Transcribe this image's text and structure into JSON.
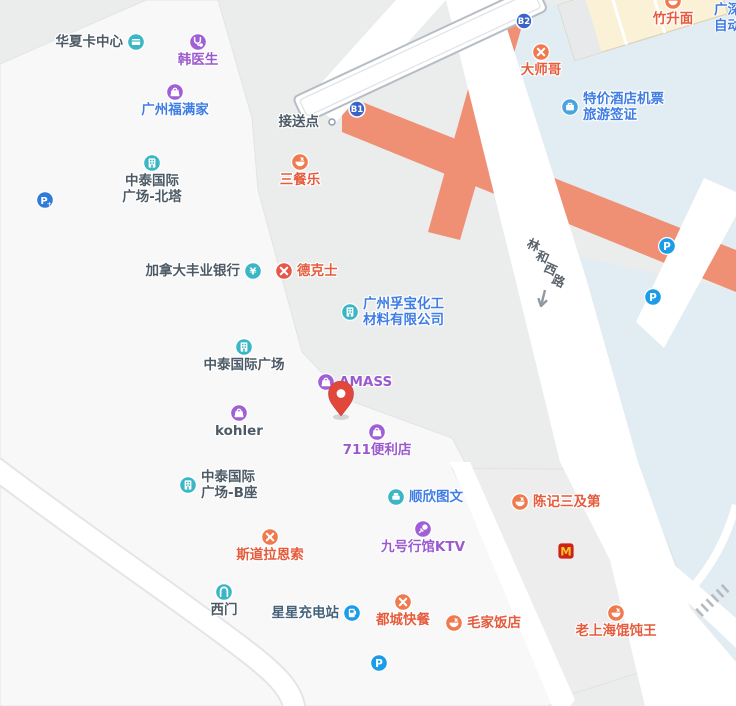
{
  "map_type": "street-map",
  "colors": {
    "base": "#ebecec",
    "block_light": "#f8f8f9",
    "block_gray": "#ededee",
    "area_blue": "#e2ecf3",
    "building_cream": "#fbf1d6",
    "walkway_salmon": "#ef8f74",
    "road_white": "#ffffff",
    "bridge_casing": "#b6bdc5",
    "cat_teal": "#3bb6c4",
    "cat_purple": "#a05fd6",
    "cat_orange": "#ef7a4e",
    "cat_red": "#e8584a",
    "cat_blue": "#4aa4e0",
    "cat_parking": "#1b9ce8",
    "cat_parking_plus": "#2e7bd8",
    "badge_blue": "#3a63c8",
    "mcd_bg": "#cf2318",
    "mcd_m": "#f7c325",
    "pin_red": "#e2473c"
  },
  "text_colors": {
    "dark": "#4d5a66",
    "blue": "#3f7de4",
    "purple": "#9b59d0",
    "orange": "#e55b3c",
    "steel": "#47637a"
  },
  "road": {
    "name": "林和西路",
    "chars": [
      "林",
      "和",
      "西",
      "路"
    ],
    "char_positions": [
      [
        534,
        244
      ],
      [
        543,
        256
      ],
      [
        551,
        268
      ],
      [
        559,
        280
      ]
    ]
  },
  "corner_text": {
    "line1": "广深",
    "line2": "自动"
  },
  "badges": [
    {
      "id": "metro-exit-b1",
      "label": "B1",
      "x": 357,
      "y": 109
    },
    {
      "id": "metro-exit-b2",
      "label": "B2",
      "x": 524,
      "y": 21
    }
  ],
  "pin": {
    "x": 341,
    "y": 419
  },
  "pois": [
    {
      "id": "huaxia-card-center",
      "label": "华夏卡中心",
      "icon": "card",
      "cat": "teal",
      "text": "dark",
      "x": 136,
      "y": 42,
      "pos": "left"
    },
    {
      "id": "han-doctor",
      "label": "韩医生",
      "icon": "medical",
      "cat": "purple",
      "text": "purple",
      "x": 198,
      "y": 42,
      "pos": "below"
    },
    {
      "id": "guangzhou-fumanjia",
      "label": "广州福满家",
      "icon": "bag",
      "cat": "purple",
      "text": "blue",
      "x": 175,
      "y": 92,
      "pos": "below"
    },
    {
      "id": "zhongtai-north-tower",
      "lines": [
        "中泰国际",
        "广场-北塔"
      ],
      "icon": "building",
      "cat": "teal",
      "text": "dark",
      "x": 152,
      "y": 163,
      "pos": "below"
    },
    {
      "id": "parking-plus-west",
      "icon": "parking-plus",
      "cat": "parking_plus",
      "x": 45,
      "y": 200,
      "pos": "none"
    },
    {
      "id": "pickup-point",
      "label": "接送点",
      "icon": "dot",
      "text": "dark",
      "x": 332,
      "y": 122,
      "pos": "left"
    },
    {
      "id": "sancanle",
      "label": "三餐乐",
      "icon": "bowl",
      "cat": "orange",
      "text": "orange",
      "x": 300,
      "y": 162,
      "pos": "below"
    },
    {
      "id": "dashige",
      "label": "大师哥",
      "icon": "utensils",
      "cat": "orange",
      "text": "orange",
      "x": 541,
      "y": 52,
      "pos": "below"
    },
    {
      "id": "zhushengmian",
      "label": "竹升面",
      "icon": "bowl",
      "cat": "orange",
      "text": "orange",
      "x": 673,
      "y": 1,
      "pos": "below"
    },
    {
      "id": "hotel-flight-deals",
      "lines": [
        "特价酒店机票",
        "旅游签证"
      ],
      "icon": "travel",
      "cat": "blue",
      "text": "blue",
      "x": 570,
      "y": 107,
      "pos": "right"
    },
    {
      "id": "scotiabank-canada",
      "label": "加拿大丰业银行",
      "icon": "yen",
      "cat": "teal",
      "text": "dark",
      "x": 253,
      "y": 271,
      "pos": "left"
    },
    {
      "id": "dicos",
      "label": "德克士",
      "icon": "utensils",
      "cat": "red",
      "text": "orange",
      "x": 284,
      "y": 271,
      "pos": "right"
    },
    {
      "id": "fubao-chemical",
      "lines": [
        "广州孚宝化工",
        "材料有限公司"
      ],
      "icon": "building",
      "cat": "teal",
      "text": "blue",
      "x": 350,
      "y": 312,
      "pos": "right"
    },
    {
      "id": "zhongtai-plaza",
      "label": "中泰国际广场",
      "icon": "building",
      "cat": "teal",
      "text": "dark",
      "x": 244,
      "y": 347,
      "pos": "below"
    },
    {
      "id": "amass",
      "label": "AMASS",
      "icon": "bag",
      "cat": "purple",
      "text": "purple",
      "x": 326,
      "y": 382,
      "pos": "right"
    },
    {
      "id": "kohler",
      "label": "kohler",
      "icon": "bag",
      "cat": "purple",
      "text": "dark",
      "x": 239,
      "y": 413,
      "pos": "below"
    },
    {
      "id": "store-711",
      "label": "711便利店",
      "icon": "bag",
      "cat": "purple",
      "text": "purple",
      "x": 377,
      "y": 432,
      "pos": "below"
    },
    {
      "id": "zhongtai-tower-b",
      "lines": [
        "中泰国际",
        "广场-B座"
      ],
      "icon": "building",
      "cat": "teal",
      "text": "dark",
      "x": 188,
      "y": 485,
      "pos": "right"
    },
    {
      "id": "shunxin-print",
      "label": "顺欣图文",
      "icon": "printer",
      "cat": "teal",
      "text": "blue",
      "x": 396,
      "y": 497,
      "pos": "right"
    },
    {
      "id": "chenji-sanjidi",
      "label": "陈记三及第",
      "icon": "bowl",
      "cat": "orange",
      "text": "orange",
      "x": 520,
      "y": 502,
      "pos": "right"
    },
    {
      "id": "stora-enso",
      "label": "斯道拉恩索",
      "icon": "utensils",
      "cat": "orange",
      "text": "orange",
      "x": 270,
      "y": 537,
      "pos": "below"
    },
    {
      "id": "ktv-no9",
      "label": "九号行馆KTV",
      "icon": "mic",
      "cat": "purple",
      "text": "purple",
      "x": 423,
      "y": 529,
      "pos": "below"
    },
    {
      "id": "mcdonalds",
      "icon": "mcd",
      "x": 566,
      "y": 551,
      "pos": "none"
    },
    {
      "id": "west-gate",
      "label": "西门",
      "icon": "gate",
      "cat": "teal",
      "text": "dark",
      "x": 224,
      "y": 592,
      "pos": "below"
    },
    {
      "id": "star-charging",
      "label": "星星充电站",
      "icon": "charger",
      "cat": "parking",
      "text": "steel",
      "x": 352,
      "y": 613,
      "pos": "left"
    },
    {
      "id": "ducheng-fastfood",
      "label": "都城快餐",
      "icon": "utensils",
      "cat": "orange",
      "text": "orange",
      "x": 403,
      "y": 602,
      "pos": "below"
    },
    {
      "id": "maojia-restaurant",
      "label": "毛家饭店",
      "icon": "bowl",
      "cat": "orange",
      "text": "orange",
      "x": 454,
      "y": 623,
      "pos": "right"
    },
    {
      "id": "old-shanghai-wonton",
      "label": "老上海馄饨王",
      "icon": "bowl",
      "cat": "orange",
      "text": "orange",
      "x": 616,
      "y": 613,
      "pos": "below"
    },
    {
      "id": "parking-north",
      "icon": "parking",
      "cat": "parking",
      "x": 667,
      "y": 246,
      "pos": "none"
    },
    {
      "id": "parking-mid",
      "icon": "parking",
      "cat": "parking",
      "x": 653,
      "y": 297,
      "pos": "none"
    },
    {
      "id": "parking-south",
      "icon": "parking",
      "cat": "parking",
      "x": 379,
      "y": 663,
      "pos": "none"
    }
  ]
}
